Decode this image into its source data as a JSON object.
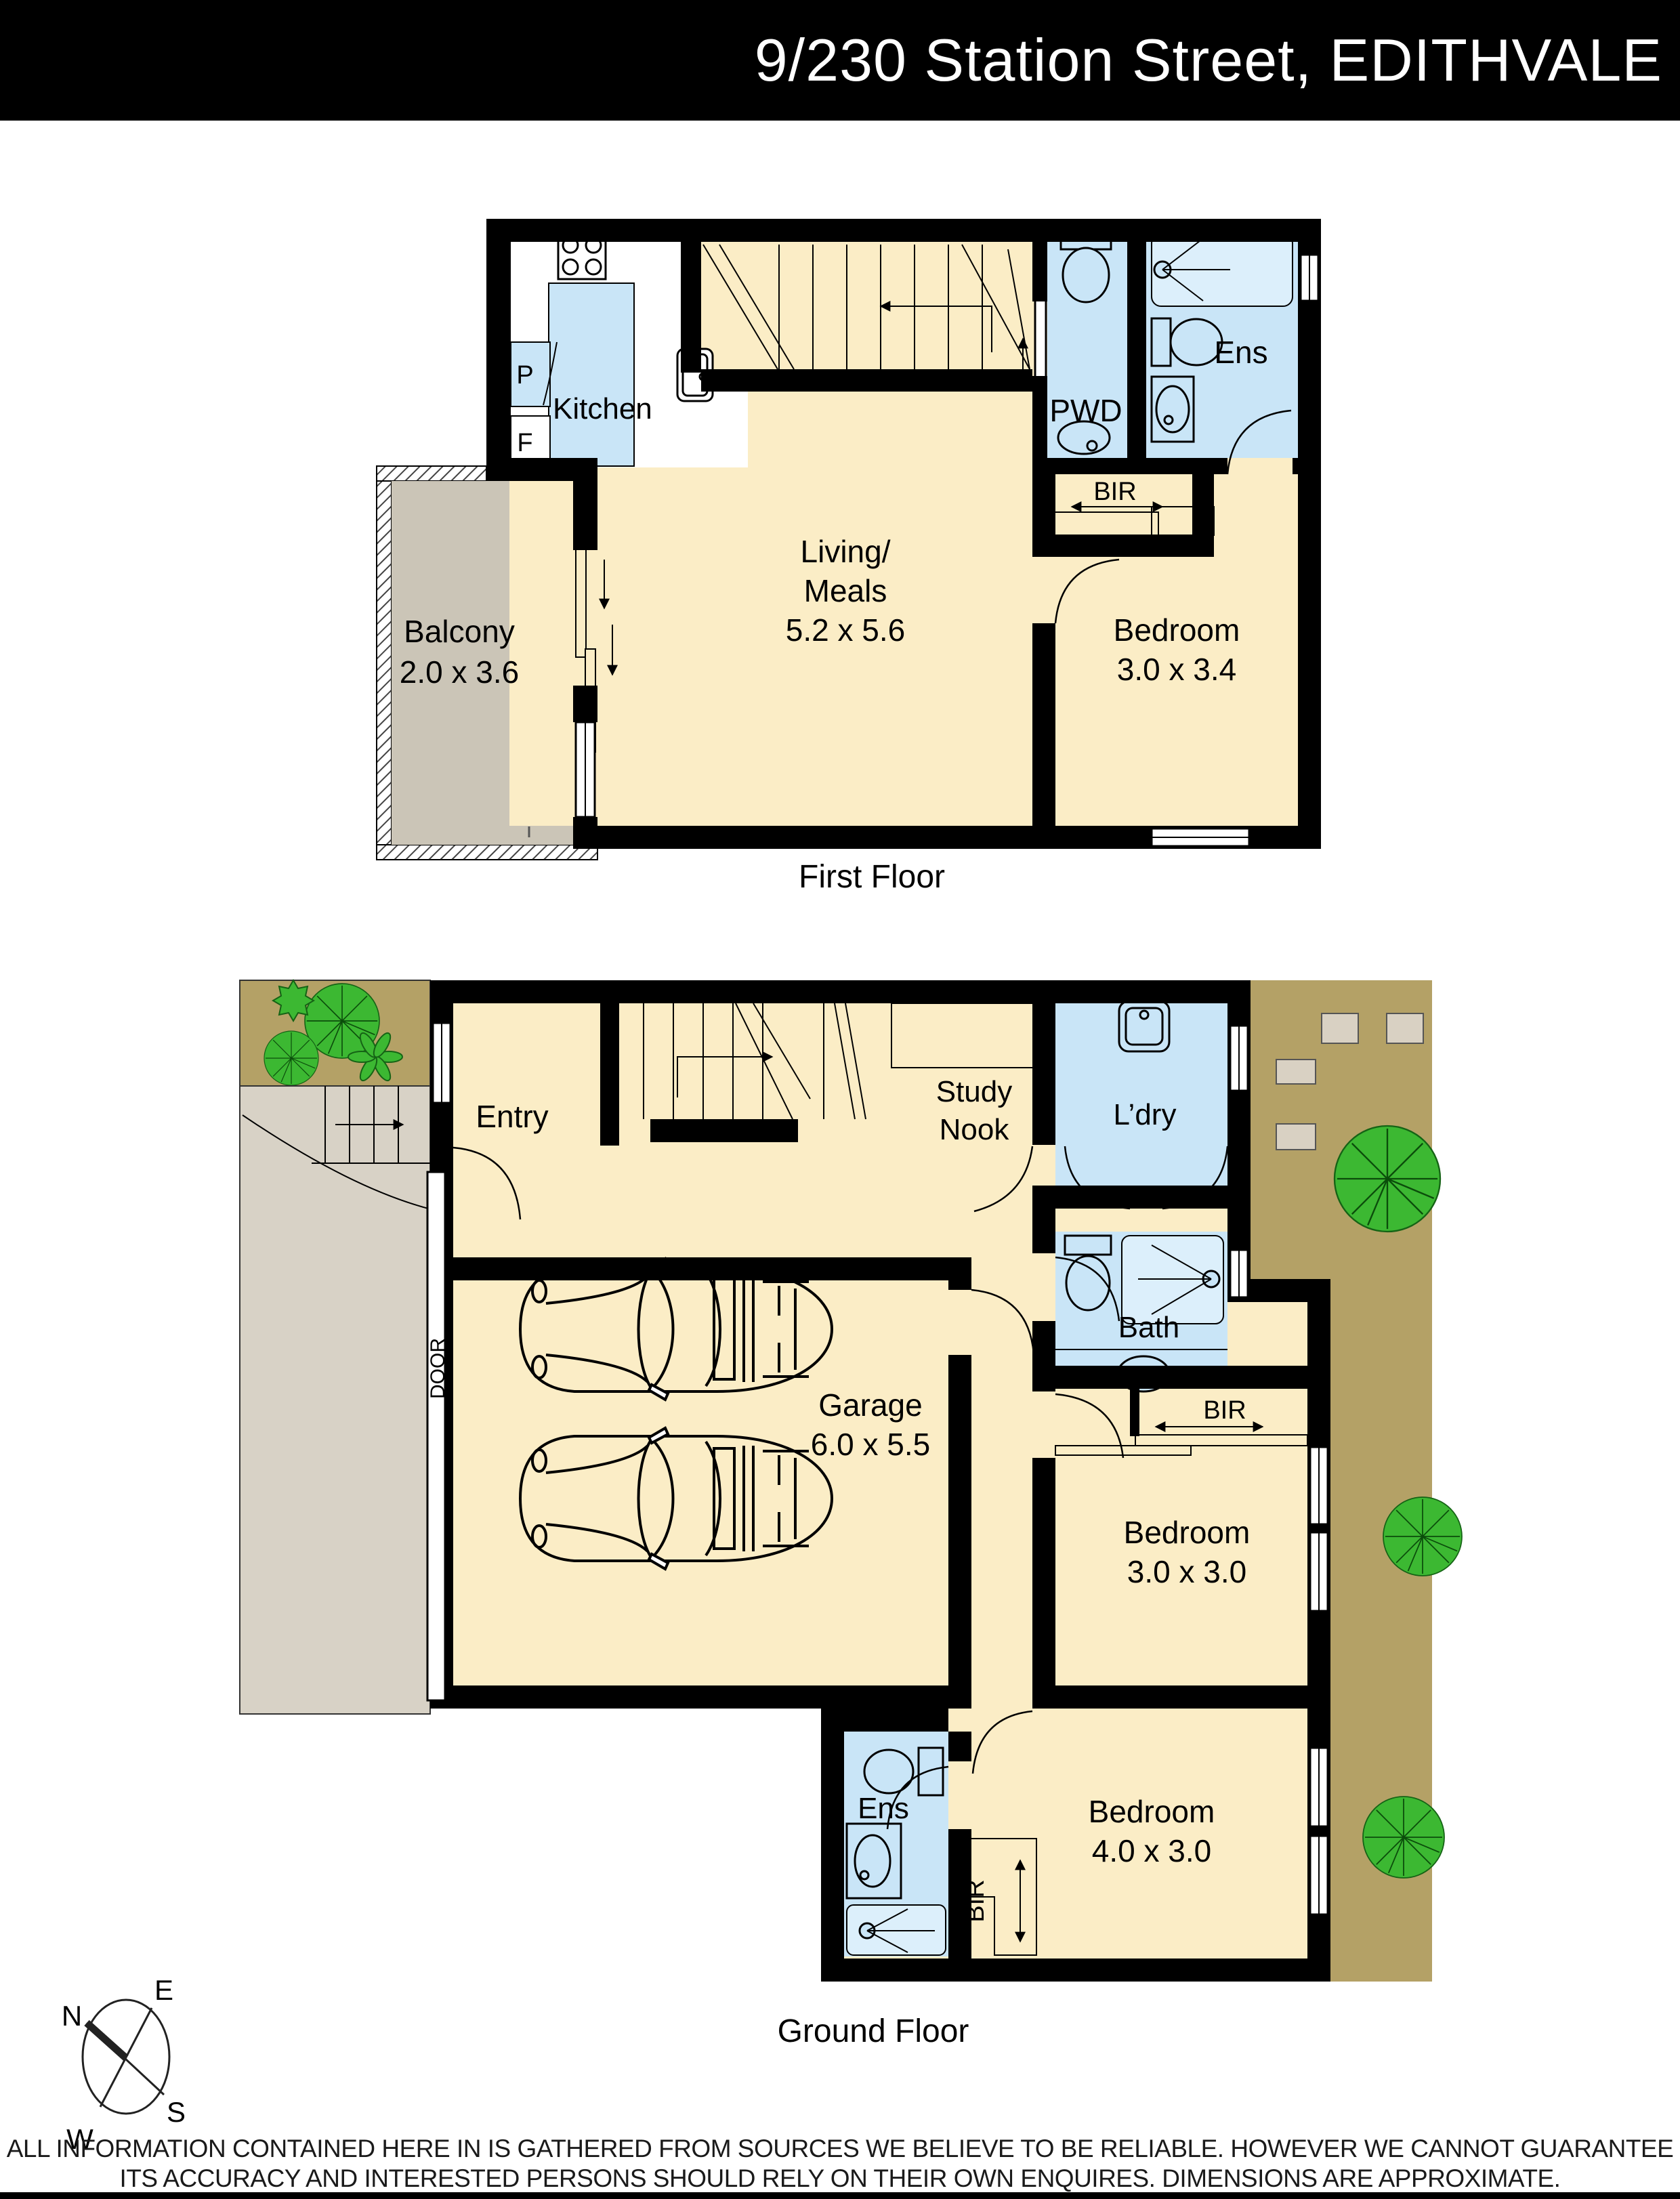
{
  "header": {
    "title": "9/230 Station Street, EDITHVALE"
  },
  "floors": {
    "first": {
      "caption": "First Floor",
      "rooms": {
        "kitchen": {
          "label": "Kitchen"
        },
        "pantry": {
          "label": "P"
        },
        "fridge": {
          "label": "F"
        },
        "pwd": {
          "label": "PWD"
        },
        "ens": {
          "label": "Ens"
        },
        "bir": {
          "label": "BIR"
        },
        "living": {
          "label1": "Living/",
          "label2": "Meals",
          "dims": "5.2 x 5.6"
        },
        "bedroom": {
          "label": "Bedroom",
          "dims": "3.0 x 3.4"
        },
        "balcony": {
          "label": "Balcony",
          "dims": "2.0 x 3.6"
        }
      }
    },
    "ground": {
      "caption": "Ground Floor",
      "rooms": {
        "entry": {
          "label": "Entry"
        },
        "study": {
          "label1": "Study",
          "label2": "Nook"
        },
        "ldry": {
          "label": "L’dry"
        },
        "bath": {
          "label": "Bath"
        },
        "garage": {
          "label": "Garage",
          "dims": "6.0 x 5.5"
        },
        "bir1": {
          "label": "BIR"
        },
        "bedroom3": {
          "label": "Bedroom",
          "dims": "3.0 x 3.0"
        },
        "ens": {
          "label": "Ens"
        },
        "bir2": {
          "label": "BIR"
        },
        "bedroom4": {
          "label": "Bedroom",
          "dims": "4.0 x 3.0"
        },
        "door": {
          "label": "DOOR"
        }
      }
    }
  },
  "compass": {
    "n": "N",
    "e": "E",
    "s": "S",
    "w": "W"
  },
  "footer": {
    "line1": "ALL INFORMATION CONTAINED HERE IN IS GATHERED FROM SOURCES WE BELIEVE TO BE RELIABLE.  HOWEVER WE CANNOT GUARANTEE",
    "line2": "ITS ACCURACY AND INTERESTED PERSONS SHOULD RELY ON THEIR OWN ENQUIRES. DIMENSIONS ARE APPROXIMATE."
  },
  "colors": {
    "wall": "#000000",
    "floor": "#FBEDC6",
    "wet": "#C9E5F7",
    "shower": "#DCEFFB",
    "balcony": "#CBC5B7",
    "drive": "#D8D2C6",
    "yard": "#B4A166",
    "paver": "#D9D1C3",
    "tree": "#3CB832"
  }
}
